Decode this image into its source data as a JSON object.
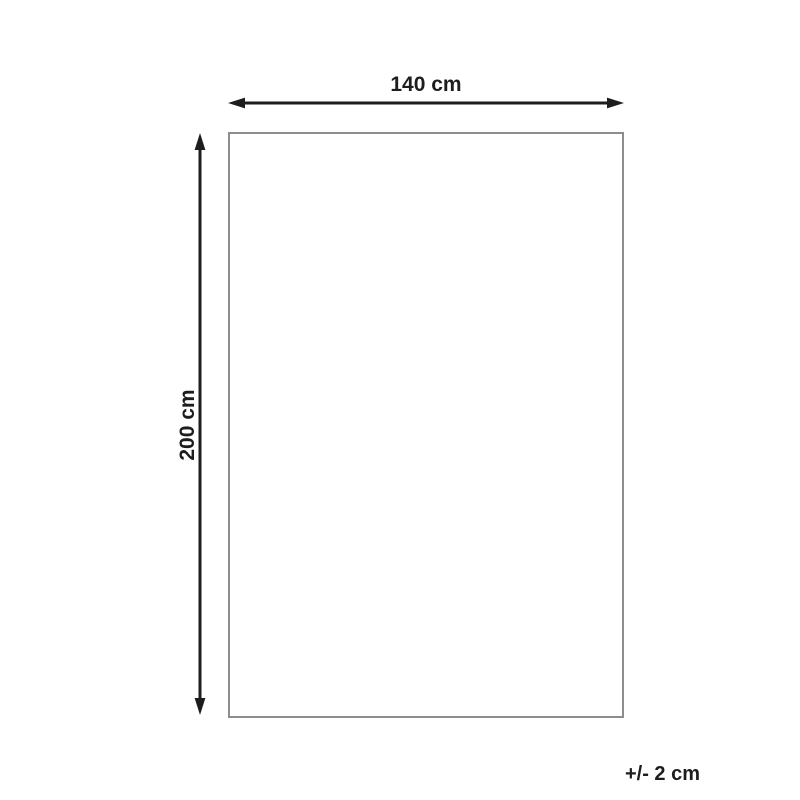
{
  "diagram": {
    "width_label": "140 cm",
    "height_label": "200 cm",
    "tolerance_label": "+/- 2 cm",
    "colors": {
      "arrow": "#1d1d1b",
      "text": "#1d1d1b",
      "outline": "#8d8d8d",
      "background": "#ffffff"
    }
  }
}
